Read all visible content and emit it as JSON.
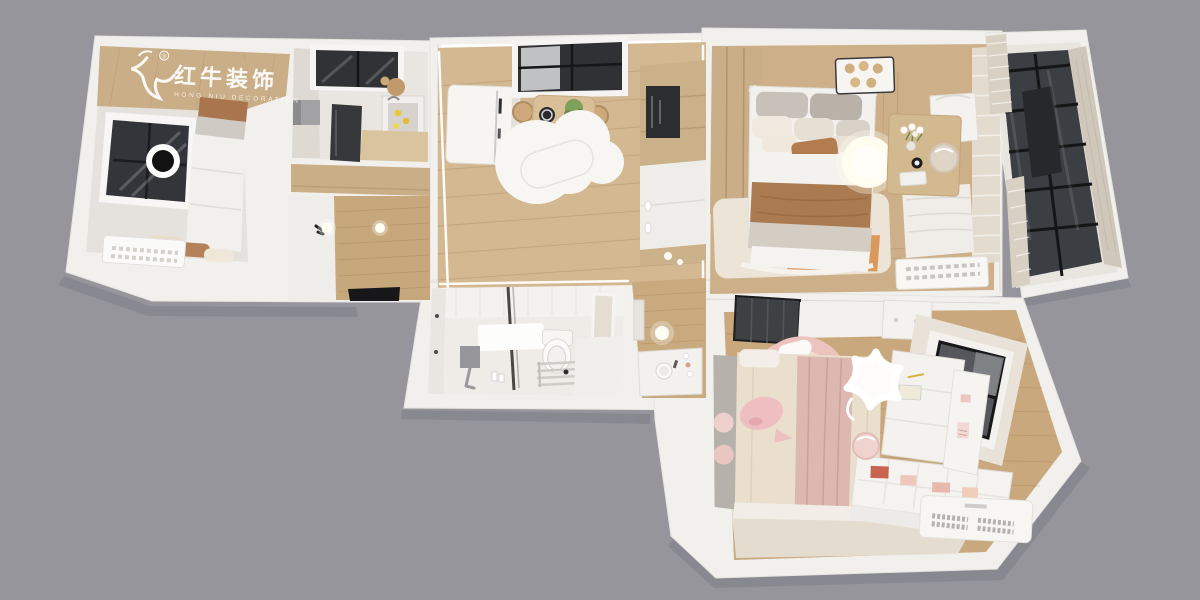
{
  "watermark": {
    "brand_zh": "红牛装饰",
    "brand_en": "HONG NIU DECORATION",
    "registered": "®"
  },
  "scene": {
    "type": "3d-apartment-floorplan-top-view-render",
    "rooms": [
      "bedroom",
      "kitchen",
      "entry-hall",
      "living-dining-room",
      "bathroom",
      "vanity-corridor",
      "master-bedroom",
      "balcony",
      "kids-bedroom"
    ]
  },
  "colors": {
    "background": "#96959b",
    "wall": "#f2f0ed",
    "floor_pale": "#e5e2dd",
    "wood_floor_living": "#d3b892",
    "wood_floor_entry": "#c7a87d",
    "wood_floor_master": "#cdb089",
    "wood_floor_kids": "#c9a87d",
    "wood_floor_corridor": "#c9aa7f",
    "wood_cabinet": "#c9ae87",
    "glass_dark": "#3b3e43",
    "tile_white": "#efece7",
    "bedding_brown": "#aa7a50",
    "accent_pink": "#eebec1",
    "rug_cream": "#ebe4d7",
    "rug_orange": "#d9995d",
    "lamp_glow": "#fffdf0"
  }
}
